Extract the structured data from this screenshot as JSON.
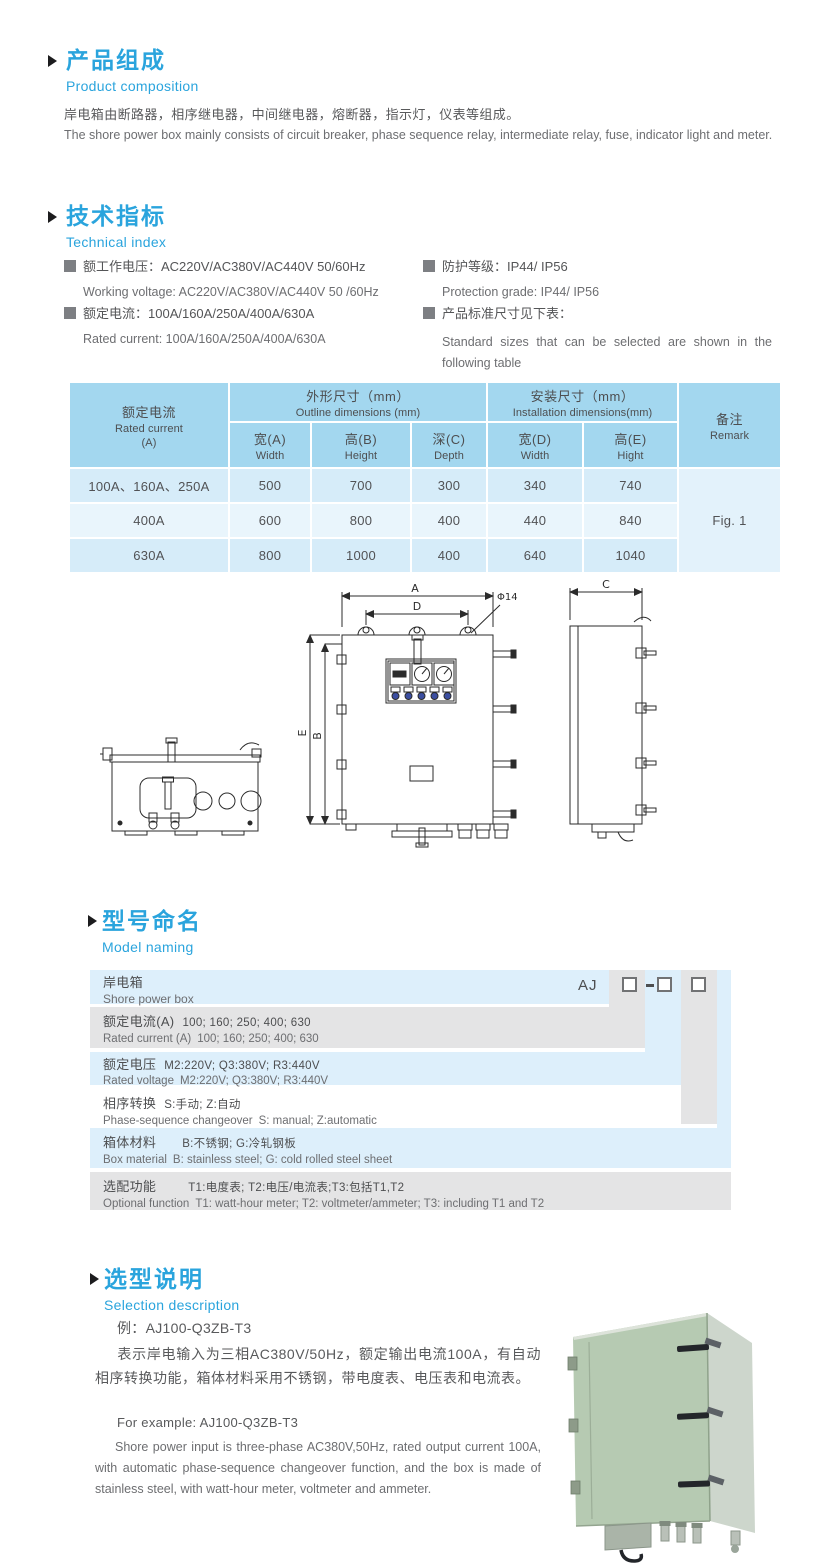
{
  "colors": {
    "accent_blue": "#2aa4dd",
    "table_header_bg": "#a3d7ef",
    "table_row_dark": "#d6ecf9",
    "table_row_light": "#e9f5fc",
    "ladder_blue": "#ddeffb",
    "ladder_gray": "#e4e4e5",
    "text_primary": "#58595b",
    "text_secondary": "#6d6e71"
  },
  "composition": {
    "title_cn": "产品组成",
    "title_en": "Product  composition",
    "body_cn": "岸电箱由断路器，相序继电器，中间继电器，熔断器，指示灯，仪表等组成。",
    "body_en": "The shore power box mainly consists of circuit breaker, phase sequence relay, intermediate relay, fuse, indicator light and meter."
  },
  "technical": {
    "title_cn": "技术指标",
    "title_en": "Technical index",
    "spec1_cn": "额工作电压：AC220V/AC380V/AC440V  50/60Hz",
    "spec1_en": "Working voltage: AC220V/AC380V/AC440V 50 /60Hz",
    "spec2_cn": "额定电流：100A/160A/250A/400A/630A",
    "spec2_en": "Rated current: 100A/160A/250A/400A/630A",
    "spec3_cn": "防护等级：IP44/ IP56",
    "spec3_en": "Protection grade: IP44/ IP56",
    "spec4_cn": "产品标准尺寸见下表：",
    "spec4_en": "Standard sizes that can be selected are shown in the following table"
  },
  "spec_table": {
    "current_cn": "额定电流",
    "current_en": "Rated current",
    "current_unit": "(A)",
    "outline_cn": "外形尺寸（mm）",
    "outline_en": "Outline dimensions (mm)",
    "install_cn": "安装尺寸（mm）",
    "install_en": "Installation dimensions(mm)",
    "remark_cn": "备注",
    "remark_en": "Remark",
    "sub_wa_cn": "宽(A)",
    "sub_wa_en": "Width",
    "sub_hb_cn": "高(B)",
    "sub_hb_en": "Height",
    "sub_dc_cn": "深(C)",
    "sub_dc_en": "Depth",
    "sub_wd_cn": "宽(D)",
    "sub_wd_en": "Width",
    "sub_he_cn": "高(E)",
    "sub_he_en": "Hight",
    "rows": [
      {
        "current": "100A、160A、250A",
        "w": "500",
        "h": "700",
        "d": "300",
        "iw": "340",
        "ih": "740"
      },
      {
        "current": "400A",
        "w": "600",
        "h": "800",
        "d": "400",
        "iw": "440",
        "ih": "840"
      },
      {
        "current": "630A",
        "w": "800",
        "h": "1000",
        "d": "400",
        "iw": "640",
        "ih": "1040"
      }
    ],
    "remark_value": "Fig. 1"
  },
  "drawing": {
    "label_a": "A",
    "label_d": "D",
    "label_phi": "Φ14",
    "label_e": "E",
    "label_b": "B",
    "label_c": "C"
  },
  "model_naming": {
    "title_cn": "型号命名",
    "title_en": "Model naming",
    "code_prefix": "AJ",
    "rows": [
      {
        "cn_label": "岸电箱",
        "cn_value": "",
        "en_label": "Shore power box",
        "en_value": ""
      },
      {
        "cn_label": "额定电流(A)",
        "cn_value": "100; 160; 250; 400; 630",
        "en_label": "Rated current (A)",
        "en_value": "100; 160; 250; 400; 630"
      },
      {
        "cn_label": "额定电压",
        "cn_value": "M2:220V;  Q3:380V;  R3:440V",
        "en_label": "Rated voltage",
        "en_value": "M2:220V;  Q3:380V;  R3:440V"
      },
      {
        "cn_label": "相序转换",
        "cn_value": "S:手动; Z:自动",
        "en_label": "Phase-sequence changeover",
        "en_value": "S: manual;  Z:automatic"
      },
      {
        "cn_label": "箱体材料",
        "cn_value": "B:不锈钢;  G:冷轧钢板",
        "en_label": "Box material",
        "en_value": "B: stainless steel; G: cold rolled steel sheet"
      },
      {
        "cn_label": "选配功能",
        "cn_value": "T1:电度表; T2:电压/电流表;T3:包括T1,T2",
        "en_label": "Optional function",
        "en_value": "T1: watt-hour meter; T2: voltmeter/ammeter; T3: including T1 and T2"
      }
    ]
  },
  "selection": {
    "title_cn": "选型说明",
    "title_en": "Selection description",
    "example_cn": "例：AJ100-Q3ZB-T3",
    "body_cn": "表示岸电输入为三相AC380V/50Hz，额定输出电流100A，有自动相序转换功能，箱体材料采用不锈钢，带电度表、电压表和电流表。",
    "example_en": "For example: AJ100-Q3ZB-T3",
    "body_en": "Shore power input is three-phase AC380V,50Hz, rated output current 100A, with automatic phase-sequence changeover function, and the box is made of stainless steel, with watt-hour meter, voltmeter and ammeter."
  }
}
